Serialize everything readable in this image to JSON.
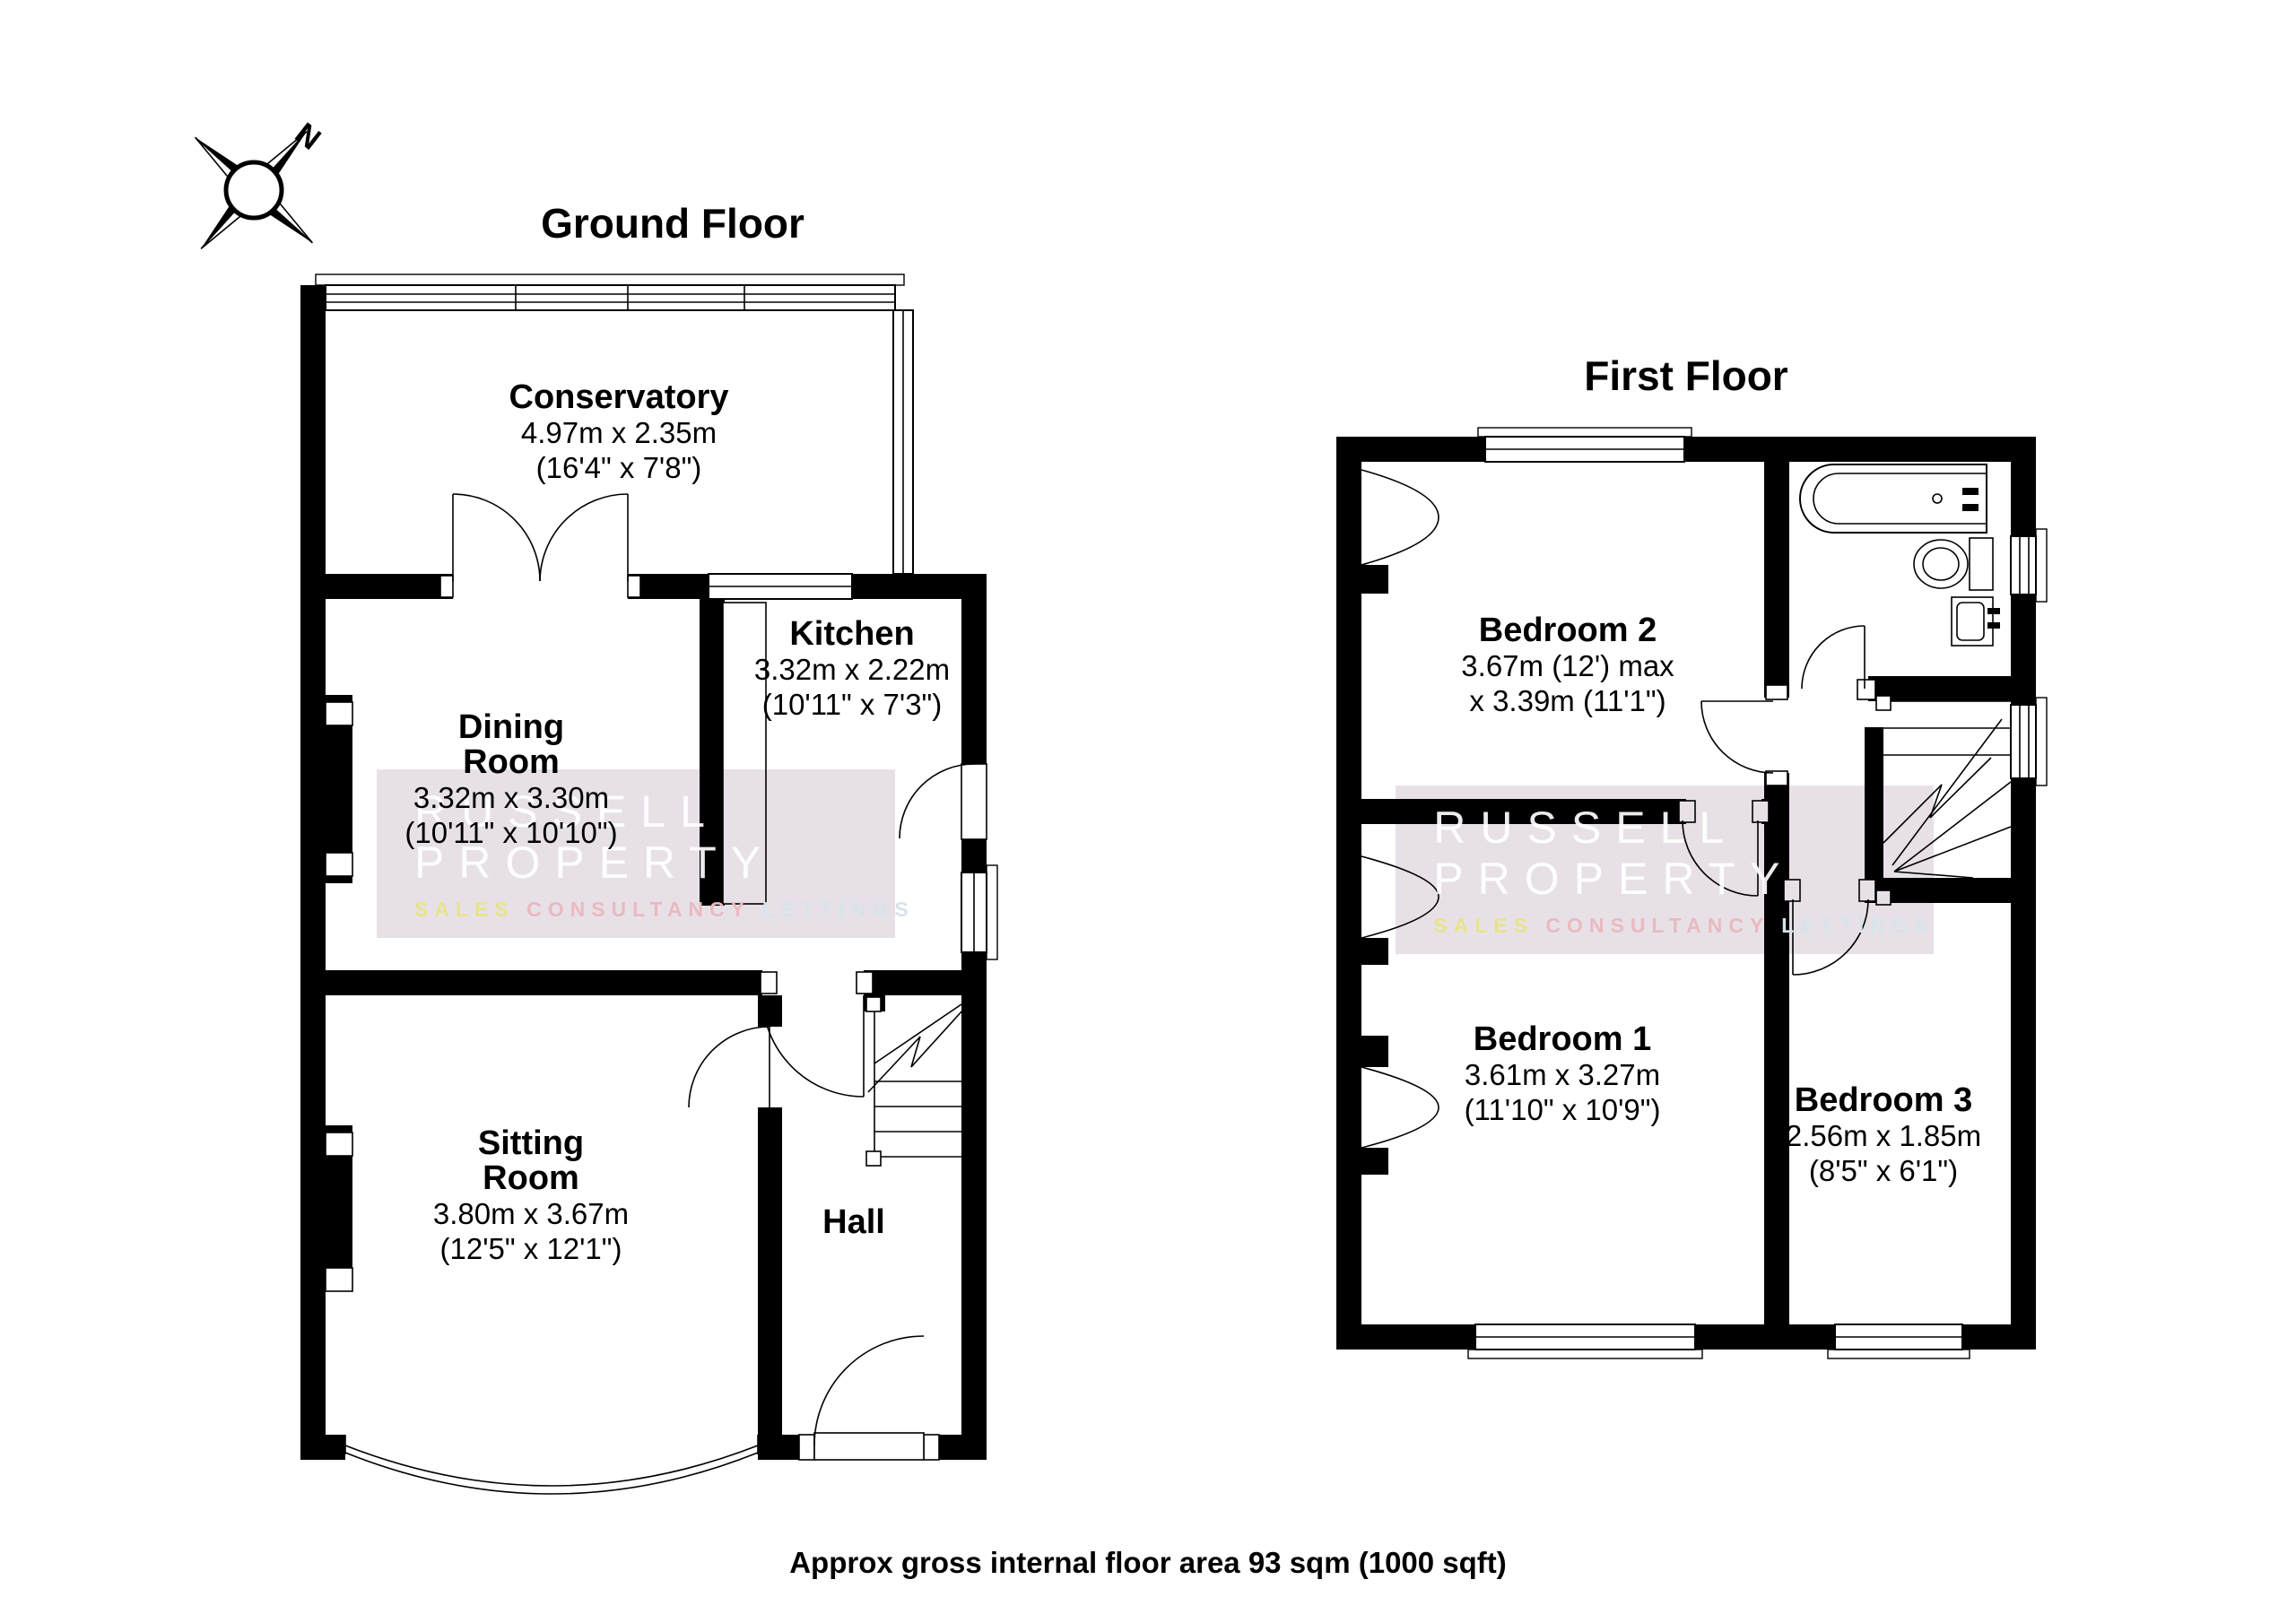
{
  "titles": {
    "ground": "Ground Floor",
    "first": "First Floor"
  },
  "compass": {
    "label": "N"
  },
  "rooms": {
    "conservatory": {
      "name": "Conservatory",
      "dim_m": "4.97m x 2.35m",
      "dim_ft": "(16'4\" x 7'8\")"
    },
    "kitchen": {
      "name": "Kitchen",
      "dim_m": "3.32m x 2.22m",
      "dim_ft": "(10'11\" x 7'3\")"
    },
    "dining": {
      "name1": "Dining",
      "name2": "Room",
      "dim_m": "3.32m x 3.30m",
      "dim_ft": "(10'11\" x 10'10\")"
    },
    "sitting": {
      "name1": "Sitting",
      "name2": "Room",
      "dim_m": "3.80m x 3.67m",
      "dim_ft": "(12'5\" x 12'1\")"
    },
    "hall": {
      "name": "Hall"
    },
    "bedroom2": {
      "name": "Bedroom 2",
      "dim_m": "3.67m (12') max",
      "dim_ft": "x 3.39m (11'1\")"
    },
    "bedroom1": {
      "name": "Bedroom 1",
      "dim_m": "3.61m x 3.27m",
      "dim_ft": "(11'10\" x 10'9\")"
    },
    "bedroom3": {
      "name": "Bedroom 3",
      "dim_m": "2.56m x 1.85m",
      "dim_ft": "(8'5\" x 6'1\")"
    }
  },
  "watermark": {
    "line1": "RUSSELL",
    "line2": "PROPERTY",
    "sub1": "SALES",
    "sub2": "CONSULTANCY",
    "sub3": "LETTINGS",
    "band_color": "#e7e1e7",
    "sub1_color": "#e8e38c",
    "sub2_color": "#eab9c0",
    "sub3_color": "#d6e4eb"
  },
  "footer": {
    "note": "Approx gross internal floor area 93 sqm (1000 sqft)"
  }
}
